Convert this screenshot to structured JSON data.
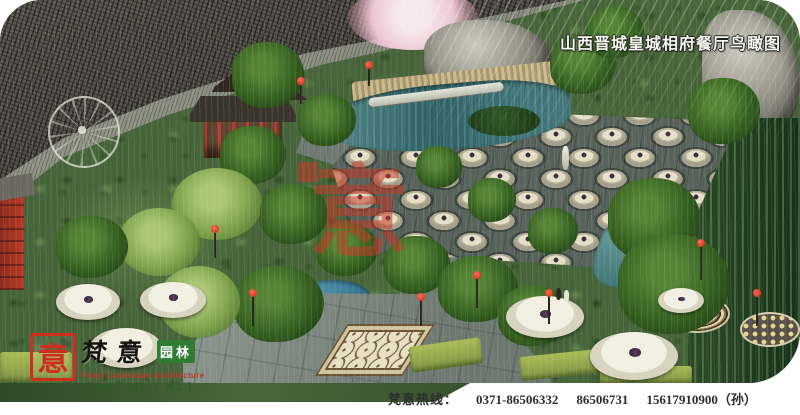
{
  "title": {
    "text": "山西晋城皇城相府餐厅鸟瞰图"
  },
  "footer": {
    "hotline_label": "梵意热线：",
    "phone1": "0371-86506332",
    "phone2": "86506731",
    "phone3": "15617910900（孙）"
  },
  "logo": {
    "seal_char": "意",
    "brand_script": "梵意",
    "brand_suffix": "园林",
    "english": "Fanyi Landscape Architecture",
    "services": "【 规划 ｜ 设计 ｜ 施工 】"
  },
  "watermark": {
    "seal_char": "意"
  },
  "colors": {
    "accent_red": "#c63826",
    "seal_red": "#cf2e1e",
    "brand_green": "#2f7d32",
    "water_teal": "#3c7276",
    "foliage_green": "#3a5a2e",
    "roof_gray": "#4b4a43",
    "stone_cream": "#ddd6bf",
    "paving_gray": "#79847c"
  }
}
